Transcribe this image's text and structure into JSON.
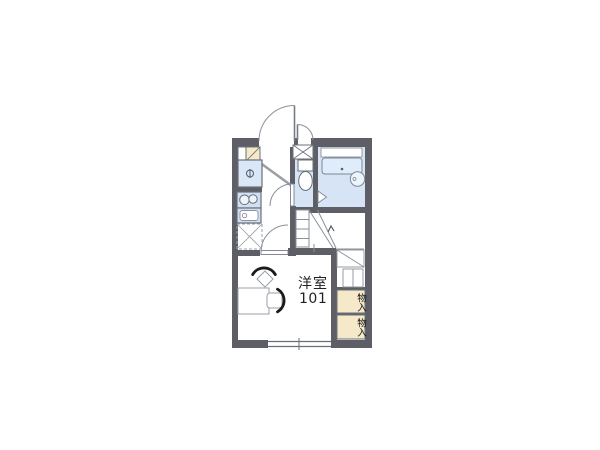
{
  "floor_plan": {
    "room": {
      "label": "洋室",
      "number": "101"
    },
    "closets": [
      {
        "label": "物入"
      },
      {
        "label": "物入"
      }
    ],
    "colors": {
      "wall": "#5e5f66",
      "wet_area_floor": "#d6e4f5",
      "fixture_blue": "#cfe0f3",
      "refrigerator_blue": "#d9e7f7",
      "bathtub_blue": "#dfecfa",
      "closet_beige": "#f5e9c9",
      "line_gray": "#8a919b",
      "background": "#ffffff"
    }
  }
}
